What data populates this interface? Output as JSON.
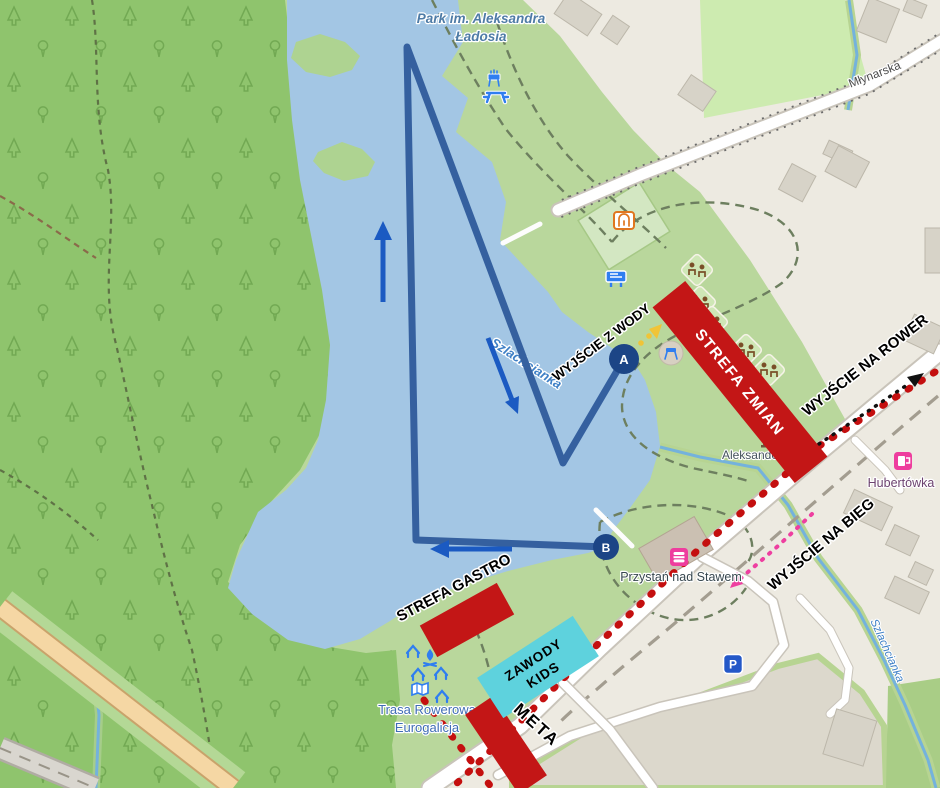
{
  "map": {
    "labels": {
      "park_line1": "Park im. Aleksandra",
      "park_line2": "Ładosia",
      "street": "Młynarska",
      "lake": "Szlachcianka",
      "stream": "Szlachcianka",
      "memorial": "Aleksander Ładoś",
      "marina": "Przystań nad Stawem",
      "pub": "Hubertówka",
      "bike_route_line1": "Trasa Rowerowa",
      "bike_route_line2": "Eurogalicja",
      "parking": "P"
    },
    "icon_names": [
      "bbq-icon",
      "picnic-table-icon",
      "playground-icon",
      "information-board-icon",
      "picnic-site-icon",
      "campfire-icon",
      "shelter-icon",
      "guidepost-map-icon",
      "fast-food-icon",
      "pub-icon",
      "parking-icon",
      "memorial-icon"
    ]
  },
  "course": {
    "labels": {
      "transition_zone": "STREFA ZMIAN",
      "water_exit": "WYJŚCIE Z WODY",
      "bike_exit": "WYJŚCIE NA ROWER",
      "run_exit": "WYJŚCIE NA BIEG",
      "food_zone": "STREFA GASTRO",
      "kids_line1": "ZAWODY",
      "kids_line2": "KIDS",
      "finish": "META"
    },
    "markers": {
      "water_exit_point": "A",
      "swim_start_point": "B"
    },
    "colors": {
      "zone_red": "#c31616",
      "kids_zone_cyan": "#5ed2dd",
      "swim_route_blue": "#35609f",
      "direction_arrow_blue": "#1b5ac2",
      "run_course_dots_red": "#c40f0f",
      "kids_route_pink": "#ee3fa0",
      "marker_navy": "#1c4586",
      "water_exit_path_yellow": "#f0c437"
    }
  }
}
